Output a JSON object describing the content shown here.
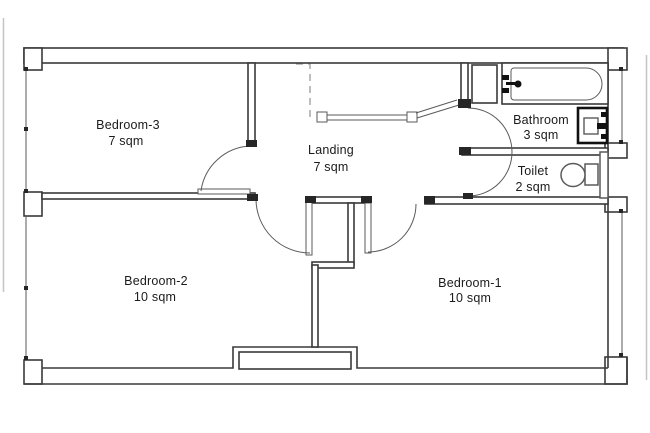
{
  "rooms": {
    "bedroom3": {
      "name": "Bedroom-3",
      "area": "7 sqm"
    },
    "landing": {
      "name": "Landing",
      "area": "7 sqm"
    },
    "bathroom": {
      "name": "Bathroom",
      "area": "3 sqm"
    },
    "toilet": {
      "name": "Toilet",
      "area": "2 sqm"
    },
    "bedroom2": {
      "name": "Bedroom-2",
      "area": "10 sqm"
    },
    "bedroom1": {
      "name": "Bedroom-1",
      "area": "10 sqm"
    }
  },
  "fixtures": {
    "bathtub": "bathtub-fixture",
    "basin": "washbasin-fixture",
    "wc": "toilet-pan-fixture",
    "cistern": "cistern-fixture",
    "railing": "stair-railing",
    "stair_void": "stair-void-dashed-line",
    "chimney": "chimney-breast"
  },
  "colors": {
    "wall": "#3a3a3a",
    "thin": "#5a5a5a",
    "cap": "#262626",
    "fixture_dark": "#111111",
    "dashed": "#a8a8a8",
    "page_edge": "#c4c4c4",
    "text": "#1b1b1b",
    "background": "#ffffff"
  }
}
